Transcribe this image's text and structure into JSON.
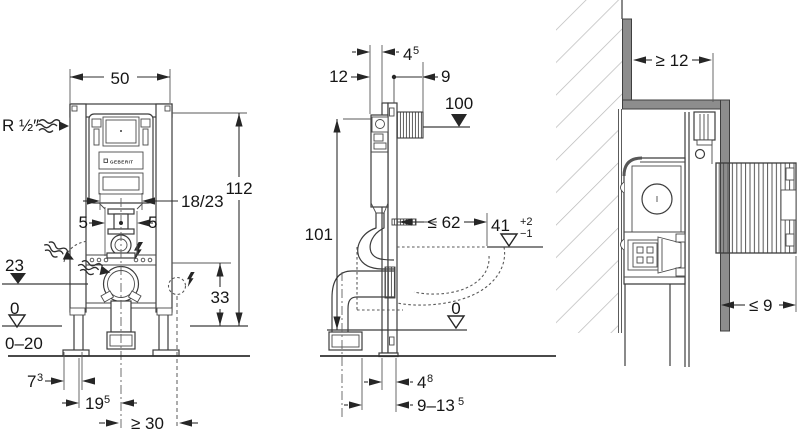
{
  "labels": {
    "front": {
      "w50": "50",
      "supply": "R ½″",
      "h112": "112",
      "offset": "18/23",
      "five_l": "5",
      "five_r": "5",
      "lvl23": "23",
      "lvl0": "0",
      "range020": "0–20",
      "d73_v": "7",
      "d73_s": "3",
      "d195_v": "19",
      "d195_s": "5",
      "ge30": "≥ 30",
      "h33": "33"
    },
    "side": {
      "d12": "12",
      "d45_v": "4",
      "d45_s": "5",
      "d9": "9",
      "lvl100": "100",
      "h101": "101",
      "le62": "≤ 62",
      "rim41": "41",
      "rim41_plus": "+2",
      "rim41_minus": "−1",
      "lvl0": "0",
      "d48_v": "4",
      "d48_s": "8",
      "d913_v": "9–13",
      "d913_s": "5"
    },
    "plan": {
      "ge12": "≥ 12",
      "le9": "≤ 9"
    },
    "brand": "GEBERIT"
  },
  "colors": {
    "ink": "#3c3c3c",
    "drywall_gray": "#8d8d8d",
    "hatch_gray": "#b9b9b9"
  }
}
